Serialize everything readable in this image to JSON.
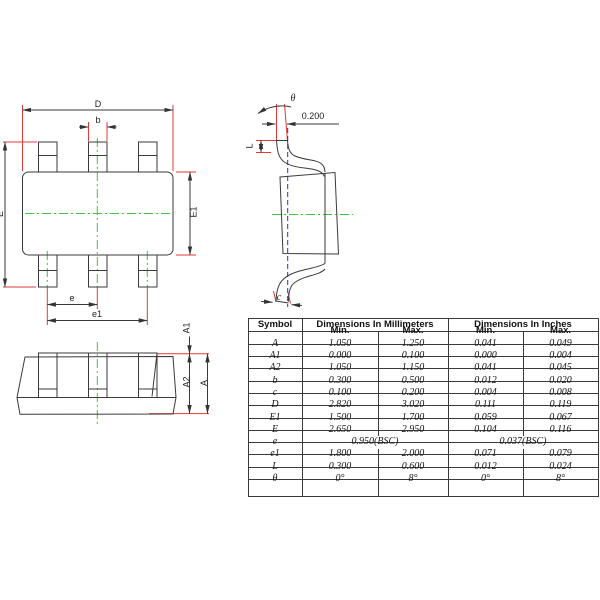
{
  "drawing": {
    "labels": {
      "D": "D",
      "b": "b",
      "E": "E",
      "E1": "E1",
      "e": "e",
      "e1": "e1",
      "A": "A",
      "A1": "A1",
      "A2": "A2",
      "L": "L",
      "c": "c",
      "theta": "θ",
      "offset": "0.200"
    },
    "colors": {
      "outline": "#3a3a3a",
      "extension": "#e03a3a",
      "centerline": "#3fc43f",
      "hidden_line": "#2b2bd6"
    }
  },
  "table": {
    "headers": {
      "symbol": "Symbol",
      "mm": "Dimensions In Millimeters",
      "inch": "Dimensions In Inches",
      "min": "Min.",
      "max": "Max."
    },
    "rows": [
      {
        "sym": "A",
        "mm_min": "1.050",
        "mm_max": "1.250",
        "in_min": "0.041",
        "in_max": "0.049"
      },
      {
        "sym": "A1",
        "mm_min": "0.000",
        "mm_max": "0.100",
        "in_min": "0.000",
        "in_max": "0.004"
      },
      {
        "sym": "A2",
        "mm_min": "1.050",
        "mm_max": "1.150",
        "in_min": "0.041",
        "in_max": "0.045"
      },
      {
        "sym": "b",
        "mm_min": "0.300",
        "mm_max": "0.500",
        "in_min": "0.012",
        "in_max": "0.020"
      },
      {
        "sym": "c",
        "mm_min": "0.100",
        "mm_max": "0.200",
        "in_min": "0.004",
        "in_max": "0.008"
      },
      {
        "sym": "D",
        "mm_min": "2.820",
        "mm_max": "3.020",
        "in_min": "0.111",
        "in_max": "0.119"
      },
      {
        "sym": "E1",
        "mm_min": "1.500",
        "mm_max": "1.700",
        "in_min": "0.059",
        "in_max": "0.067"
      },
      {
        "sym": "E",
        "mm_min": "2.650",
        "mm_max": "2.950",
        "in_min": "0.104",
        "in_max": "0.116"
      },
      {
        "sym": "e",
        "span": true,
        "mm": "0.950(BSC)",
        "in": "0.037(BSC)"
      },
      {
        "sym": "e1",
        "mm_min": "1.800",
        "mm_max": "2.000",
        "in_min": "0.071",
        "in_max": "0.079"
      },
      {
        "sym": "L",
        "mm_min": "0.300",
        "mm_max": "0.600",
        "in_min": "0.012",
        "in_max": "0.024"
      },
      {
        "sym": "θ",
        "mm_min": "0°",
        "mm_max": "8°",
        "in_min": "0°",
        "in_max": "8°"
      }
    ]
  }
}
